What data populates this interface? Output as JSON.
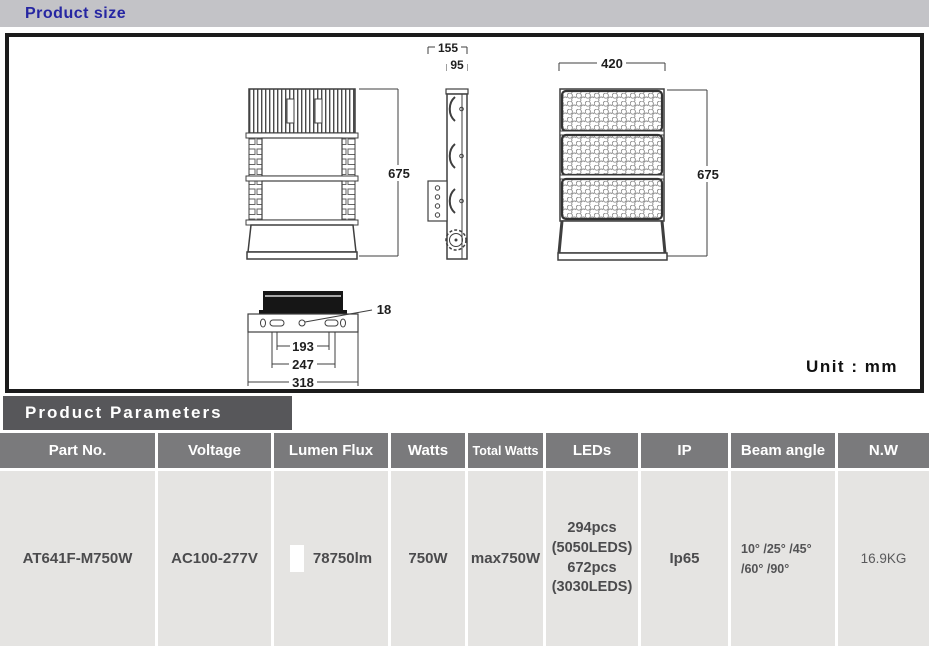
{
  "sections": {
    "product_size_title": "Product size",
    "product_parameters_title": "Product  Parameters",
    "unit_label": "Unit : mm"
  },
  "drawing": {
    "back_view": {
      "height_dim": "675"
    },
    "side_view": {
      "overall_width_dim": "155",
      "body_width_dim": "95"
    },
    "front_view": {
      "width_dim": "420",
      "height_dim": "675"
    },
    "bottom_view": {
      "hole_dim": "18",
      "inner_dim": "193",
      "middle_dim": "247",
      "outer_dim": "318"
    }
  },
  "table": {
    "headers": [
      "Part No.",
      "Voltage",
      "Lumen Flux",
      "Watts",
      "Total Watts",
      "LEDs",
      "IP",
      "Beam angle",
      "N.W"
    ],
    "row": {
      "part_no": "AT641F-M750W",
      "voltage": "AC100-277V",
      "lumen_flux": "78750lm",
      "watts": "750W",
      "total_watts": "max750W",
      "leds_line1": "294pcs",
      "leds_line2": "(5050LEDS)",
      "leds_line3": "672pcs",
      "leds_line4": "(3030LEDS)",
      "ip": "Ip65",
      "beam_angle_line1": "10° /25° /45°",
      "beam_angle_line2": "/60° /90°",
      "net_weight": "16.9KG"
    }
  },
  "colors": {
    "title_blue": "#2626a2",
    "section_bar_gray": "#c3c3c7",
    "dark_bar_gray": "#57575a",
    "table_header_gray": "#7a7a7c",
    "table_row_gray": "#e5e4e2"
  }
}
